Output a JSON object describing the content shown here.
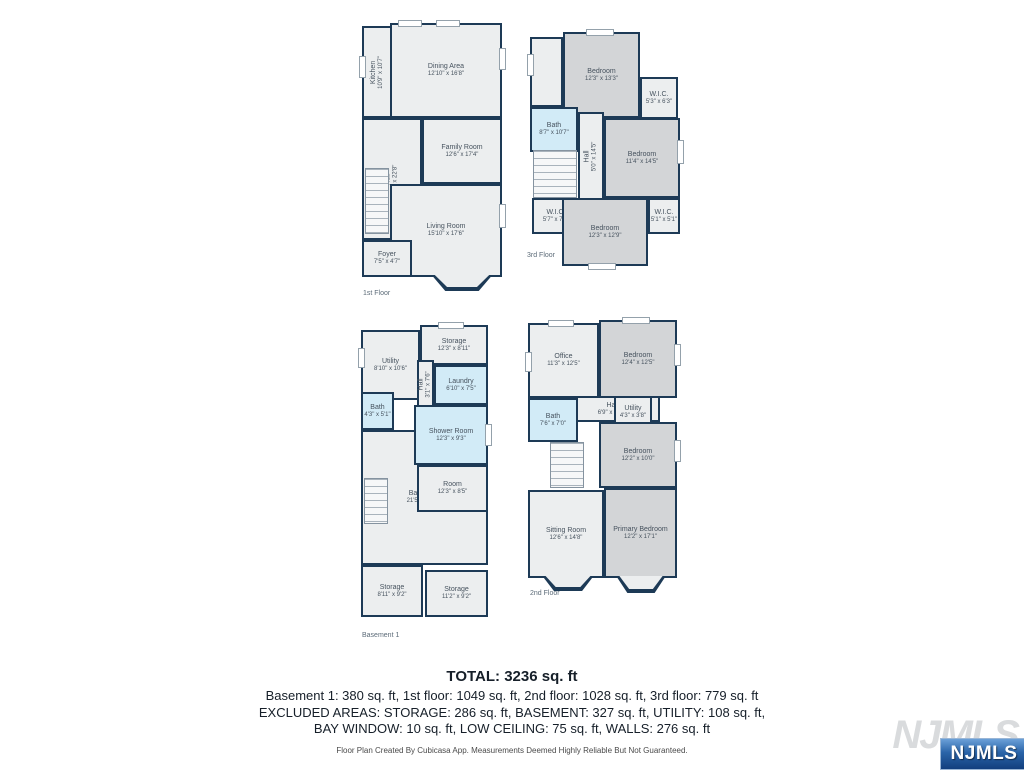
{
  "colors": {
    "wall": "#1d3a56",
    "floor": "#eceeef",
    "gray": "#d3d5d7",
    "blue": "#d2ebf7"
  },
  "floors": [
    {
      "label": "1st Floor",
      "label_x": 363,
      "label_y": 290,
      "rooms": [
        {
          "name": "Kitchen",
          "dims": "10'9\" x 10'7\"",
          "x": 362,
          "y": 26,
          "w": 30,
          "h": 92,
          "fill": "floor",
          "vertical": true
        },
        {
          "name": "Dining Area",
          "dims": "12'10\" x 16'8\"",
          "x": 390,
          "y": 23,
          "w": 112,
          "h": 95,
          "fill": "floor"
        },
        {
          "name": "Family Room",
          "dims": "12'6\" x 17'4\"",
          "x": 422,
          "y": 118,
          "w": 80,
          "h": 66,
          "fill": "floor"
        },
        {
          "name": "Hall",
          "dims": "7'6\" x 22'8\"",
          "x": 362,
          "y": 118,
          "w": 60,
          "h": 122,
          "fill": "floor",
          "vertical": true
        },
        {
          "name": "Living Room",
          "dims": "15'10\" x 17'6\"",
          "x": 390,
          "y": 184,
          "w": 112,
          "h": 93,
          "fill": "floor"
        },
        {
          "name": "Foyer",
          "dims": "7'5\" x 4'7\"",
          "x": 362,
          "y": 240,
          "w": 50,
          "h": 37,
          "fill": "floor"
        }
      ],
      "stairs": [
        {
          "x": 365,
          "y": 168,
          "w": 24,
          "h": 66
        }
      ],
      "windows": [
        {
          "x": 398,
          "y": 20,
          "w": 24,
          "h": 7
        },
        {
          "x": 436,
          "y": 20,
          "w": 24,
          "h": 7
        },
        {
          "x": 499,
          "y": 48,
          "w": 7,
          "h": 22
        },
        {
          "x": 499,
          "y": 204,
          "w": 7,
          "h": 24
        },
        {
          "x": 359,
          "y": 56,
          "w": 7,
          "h": 22
        }
      ],
      "bays": [
        {
          "x": 424,
          "y": 275,
          "w": 76,
          "h": 16
        }
      ]
    },
    {
      "label": "3rd Floor",
      "label_x": 527,
      "label_y": 252,
      "rooms": [
        {
          "name": "",
          "dims": "",
          "x": 530,
          "y": 37,
          "w": 33,
          "h": 70,
          "fill": "floor"
        },
        {
          "name": "Bedroom",
          "dims": "12'3\" x 13'3\"",
          "x": 563,
          "y": 32,
          "w": 77,
          "h": 86,
          "fill": "gray"
        },
        {
          "name": "W.I.C.",
          "dims": "5'3\" x 6'3\"",
          "x": 640,
          "y": 77,
          "w": 38,
          "h": 42,
          "fill": "floor"
        },
        {
          "name": "Bath",
          "dims": "8'7\" x 10'7\"",
          "x": 530,
          "y": 107,
          "w": 48,
          "h": 45,
          "fill": "blue"
        },
        {
          "name": "Hall",
          "dims": "5'0\" x 14'5\"",
          "x": 578,
          "y": 112,
          "w": 26,
          "h": 88,
          "fill": "floor",
          "vertical": true
        },
        {
          "name": "Bedroom",
          "dims": "11'4\" x 14'5\"",
          "x": 604,
          "y": 118,
          "w": 76,
          "h": 80,
          "fill": "gray"
        },
        {
          "name": "W.I.C.",
          "dims": "5'7\" x 7'0\"",
          "x": 532,
          "y": 198,
          "w": 48,
          "h": 36,
          "fill": "floor"
        },
        {
          "name": "W.I.C.",
          "dims": "5'1\" x 5'1\"",
          "x": 648,
          "y": 198,
          "w": 32,
          "h": 36,
          "fill": "floor"
        },
        {
          "name": "Bedroom",
          "dims": "12'3\" x 12'9\"",
          "x": 562,
          "y": 198,
          "w": 86,
          "h": 68,
          "fill": "gray"
        }
      ],
      "stairs": [
        {
          "x": 533,
          "y": 150,
          "w": 44,
          "h": 48
        }
      ],
      "windows": [
        {
          "x": 586,
          "y": 29,
          "w": 28,
          "h": 7
        },
        {
          "x": 677,
          "y": 140,
          "w": 7,
          "h": 24
        },
        {
          "x": 588,
          "y": 263,
          "w": 28,
          "h": 7
        },
        {
          "x": 527,
          "y": 54,
          "w": 7,
          "h": 22
        }
      ],
      "bays": []
    },
    {
      "label": "Basement 1",
      "label_x": 362,
      "label_y": 632,
      "rooms": [
        {
          "name": "Storage",
          "dims": "12'3\" x 8'11\"",
          "x": 420,
          "y": 325,
          "w": 68,
          "h": 40,
          "fill": "floor"
        },
        {
          "name": "Utility",
          "dims": "8'10\" x 10'6\"",
          "x": 361,
          "y": 330,
          "w": 59,
          "h": 70,
          "fill": "floor"
        },
        {
          "name": "Laundry",
          "dims": "6'10\" x 7'5\"",
          "x": 434,
          "y": 365,
          "w": 54,
          "h": 40,
          "fill": "blue"
        },
        {
          "name": "Hall",
          "dims": "3'1\" x 7'6\"",
          "x": 417,
          "y": 360,
          "w": 17,
          "h": 48,
          "fill": "floor",
          "vertical": true
        },
        {
          "name": "Bath",
          "dims": "4'3\" x 5'1\"",
          "x": 361,
          "y": 392,
          "w": 33,
          "h": 38,
          "fill": "blue"
        },
        {
          "name": "Basement",
          "dims": "21'5\" x 28'11\"",
          "x": 361,
          "y": 430,
          "w": 127,
          "h": 135,
          "fill": "floor"
        },
        {
          "name": "Shower Room",
          "dims": "12'3\" x 9'3\"",
          "x": 414,
          "y": 405,
          "w": 74,
          "h": 60,
          "fill": "blue"
        },
        {
          "name": "Room",
          "dims": "12'3\" x 8'5\"",
          "x": 417,
          "y": 465,
          "w": 71,
          "h": 47,
          "fill": "floor"
        },
        {
          "name": "Storage",
          "dims": "8'11\" x 9'2\"",
          "x": 361,
          "y": 565,
          "w": 62,
          "h": 52,
          "fill": "floor"
        },
        {
          "name": "Storage",
          "dims": "11'2\" x 9'2\"",
          "x": 425,
          "y": 570,
          "w": 63,
          "h": 47,
          "fill": "floor"
        }
      ],
      "stairs": [
        {
          "x": 364,
          "y": 478,
          "w": 24,
          "h": 46
        }
      ],
      "windows": [
        {
          "x": 438,
          "y": 322,
          "w": 26,
          "h": 7
        },
        {
          "x": 485,
          "y": 424,
          "w": 7,
          "h": 22
        },
        {
          "x": 358,
          "y": 348,
          "w": 7,
          "h": 20
        }
      ],
      "bays": []
    },
    {
      "label": "2nd Floor",
      "label_x": 530,
      "label_y": 590,
      "rooms": [
        {
          "name": "Office",
          "dims": "11'3\" x 12'5\"",
          "x": 528,
          "y": 323,
          "w": 71,
          "h": 75,
          "fill": "floor"
        },
        {
          "name": "Bedroom",
          "dims": "12'4\" x 12'5\"",
          "x": 599,
          "y": 320,
          "w": 78,
          "h": 78,
          "fill": "gray"
        },
        {
          "name": "Hall",
          "dims": "6'9\" x 17'4\"",
          "x": 565,
          "y": 396,
          "w": 95,
          "h": 26,
          "fill": "floor"
        },
        {
          "name": "Bath",
          "dims": "7'6\" x 7'0\"",
          "x": 528,
          "y": 398,
          "w": 50,
          "h": 44,
          "fill": "blue"
        },
        {
          "name": "Utility",
          "dims": "4'3\" x 3'8\"",
          "x": 614,
          "y": 396,
          "w": 38,
          "h": 32,
          "fill": "floor"
        },
        {
          "name": "Bedroom",
          "dims": "12'2\" x 10'0\"",
          "x": 599,
          "y": 422,
          "w": 78,
          "h": 66,
          "fill": "gray"
        },
        {
          "name": "Sitting Room",
          "dims": "12'6\" x 14'8\"",
          "x": 528,
          "y": 490,
          "w": 76,
          "h": 88,
          "fill": "floor"
        },
        {
          "name": "Primary Bedroom",
          "dims": "12'2\" x 17'1\"",
          "x": 604,
          "y": 488,
          "w": 73,
          "h": 90,
          "fill": "gray"
        }
      ],
      "stairs": [
        {
          "x": 550,
          "y": 442,
          "w": 34,
          "h": 46
        }
      ],
      "windows": [
        {
          "x": 548,
          "y": 320,
          "w": 26,
          "h": 7
        },
        {
          "x": 622,
          "y": 317,
          "w": 28,
          "h": 7
        },
        {
          "x": 674,
          "y": 344,
          "w": 7,
          "h": 22
        },
        {
          "x": 674,
          "y": 440,
          "w": 7,
          "h": 22
        },
        {
          "x": 525,
          "y": 352,
          "w": 7,
          "h": 20
        }
      ],
      "bays": [
        {
          "x": 536,
          "y": 576,
          "w": 64,
          "h": 15
        },
        {
          "x": 610,
          "y": 576,
          "w": 62,
          "h": 17
        }
      ]
    }
  ],
  "summary": {
    "total": "TOTAL: 3236 sq. ft",
    "line1": "Basement 1: 380 sq. ft, 1st floor: 1049 sq. ft, 2nd floor: 1028 sq. ft, 3rd floor: 779 sq. ft",
    "line2": "EXCLUDED AREAS: STORAGE: 286 sq. ft, BASEMENT: 327 sq. ft, UTILITY: 108 sq. ft,",
    "line3": "BAY WINDOW: 10 sq. ft, LOW CEILING: 75 sq. ft, WALLS: 276 sq. ft"
  },
  "footer": {
    "disclaimer": "Floor Plan Created By Cubicasa App. Measurements Deemed Highly Reliable But Not Guaranteed."
  },
  "logo": {
    "watermark": "NJMLS",
    "badge": "NJMLS"
  }
}
